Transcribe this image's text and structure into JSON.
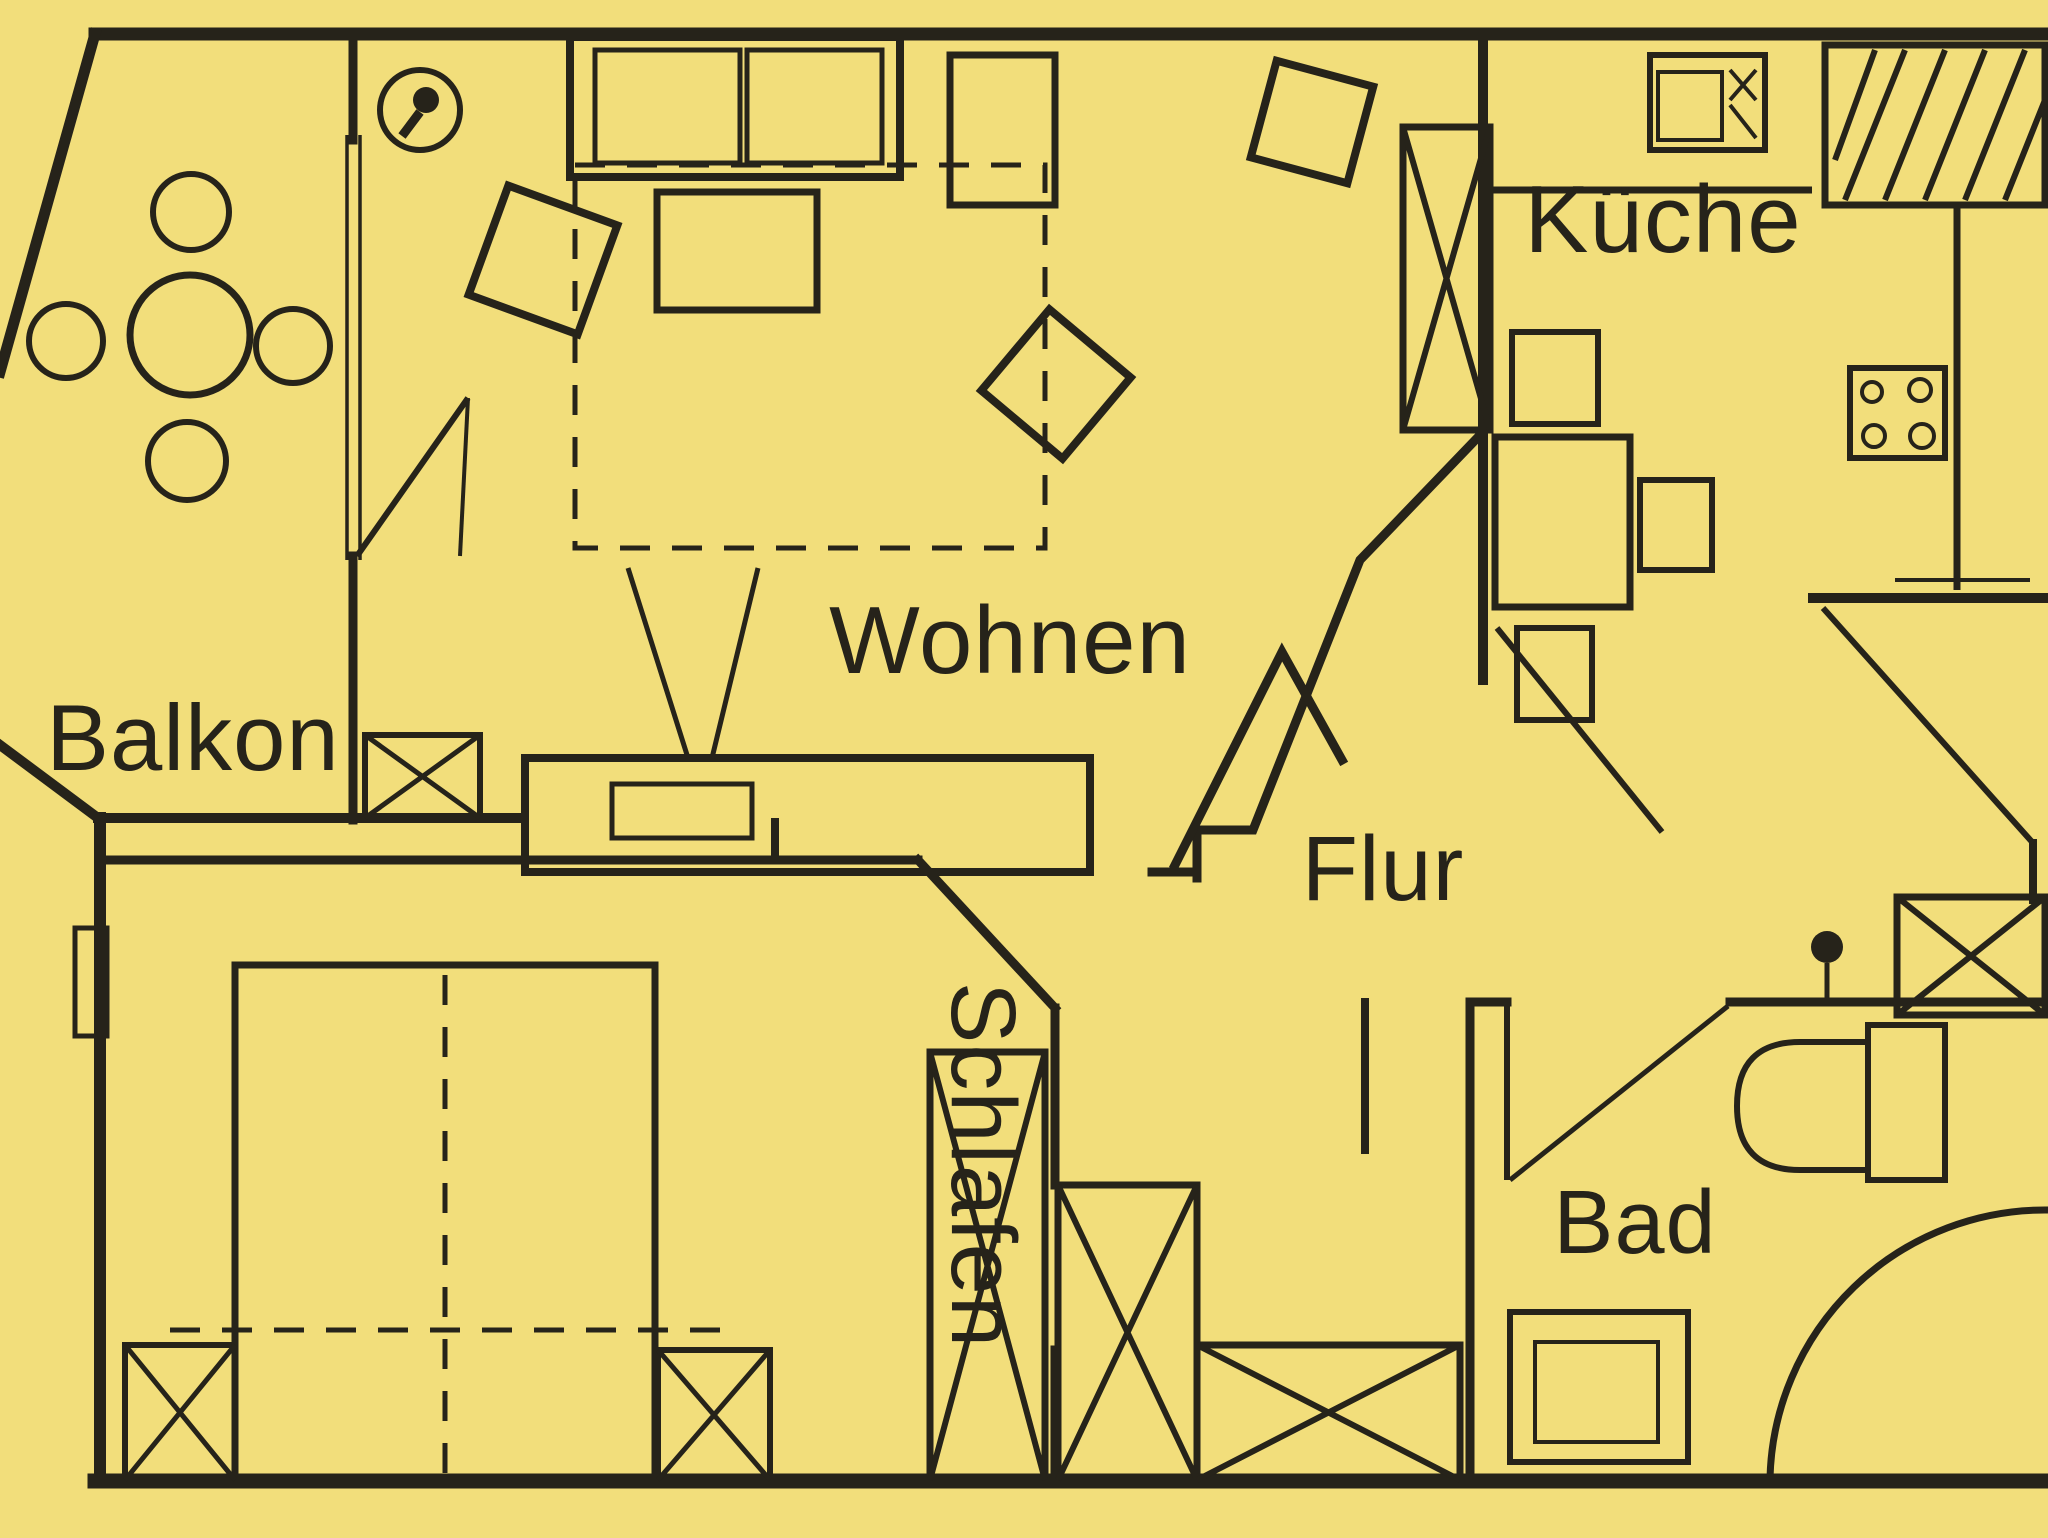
{
  "title": "Wohnungsgrundriss (apartment floor plan)",
  "colors": {
    "background": "#f2de7b",
    "line": "#26231a"
  },
  "rooms": {
    "balkon": {
      "label": "Balkon"
    },
    "wohnen": {
      "label": "Wohnen"
    },
    "kueche": {
      "label": "Küche"
    },
    "flur": {
      "label": "Flur"
    },
    "schlafen": {
      "label": "Schlafen"
    },
    "bad": {
      "label": "Bad"
    }
  }
}
